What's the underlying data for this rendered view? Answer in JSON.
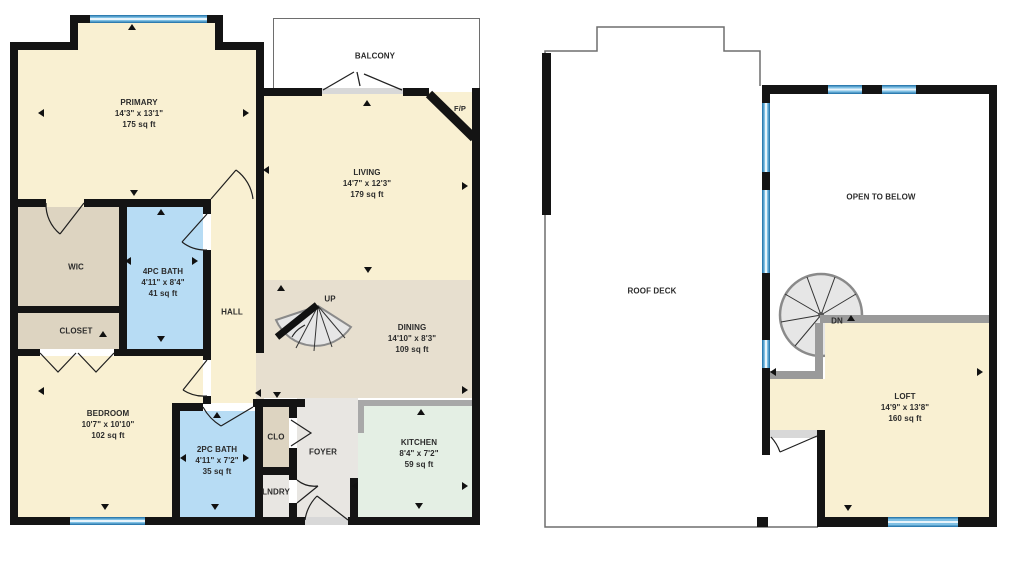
{
  "colors": {
    "wall": "#141414",
    "cream": "#f9f0d2",
    "tan": "#ddd4c1",
    "dining_tan": "#e7dfcf",
    "bath_blue": "#b7dcf4",
    "kitchen_mint": "#e4efe4",
    "foyer_gray": "#e8e6e2",
    "window_edge": "#2e7cb0",
    "window_mid": "#7fc0e4",
    "window_center": "#e8f4fb",
    "halfwall_gray": "#9a9a9a",
    "sill_gray": "#d8d8d8",
    "counter_gray": "#a8a8a8",
    "stair_fill": "#e6e6e6",
    "stair_rim": "#8a8a8a"
  },
  "plans": {
    "left": {
      "rooms": {
        "primary": {
          "name": "PRIMARY",
          "dims": "14'3\" x 13'1\"",
          "area": "175 sq ft"
        },
        "wic": {
          "name": "WIC"
        },
        "closet": {
          "name": "CLOSET"
        },
        "bath4": {
          "name": "4PC BATH",
          "dims": "4'11\" x 8'4\"",
          "area": "41 sq ft"
        },
        "hall": {
          "name": "HALL"
        },
        "bedroom": {
          "name": "BEDROOM",
          "dims": "10'7\" x 10'10\"",
          "area": "102 sq ft"
        },
        "bath2": {
          "name": "2PC BATH",
          "dims": "4'11\" x 7'2\"",
          "area": "35 sq ft"
        },
        "clo": {
          "name": "CLO"
        },
        "lndry": {
          "name": "LNDRY"
        },
        "foyer": {
          "name": "FOYER"
        },
        "kitchen": {
          "name": "KITCHEN",
          "dims": "8'4\" x 7'2\"",
          "area": "59 sq ft"
        },
        "dining": {
          "name": "DINING",
          "dims": "14'10\" x 8'3\"",
          "area": "109 sq ft"
        },
        "living": {
          "name": "LIVING",
          "dims": "14'7\" x 12'3\"",
          "area": "179 sq ft"
        },
        "balcony": {
          "name": "BALCONY"
        },
        "fp": {
          "name": "F/P"
        },
        "up": {
          "name": "UP"
        }
      }
    },
    "right": {
      "rooms": {
        "roof_deck": {
          "name": "ROOF DECK"
        },
        "open_below": {
          "name": "OPEN TO BELOW"
        },
        "loft": {
          "name": "LOFT",
          "dims": "14'9\" x 13'8\"",
          "area": "160 sq ft"
        },
        "dn": {
          "name": "DN"
        }
      }
    }
  }
}
